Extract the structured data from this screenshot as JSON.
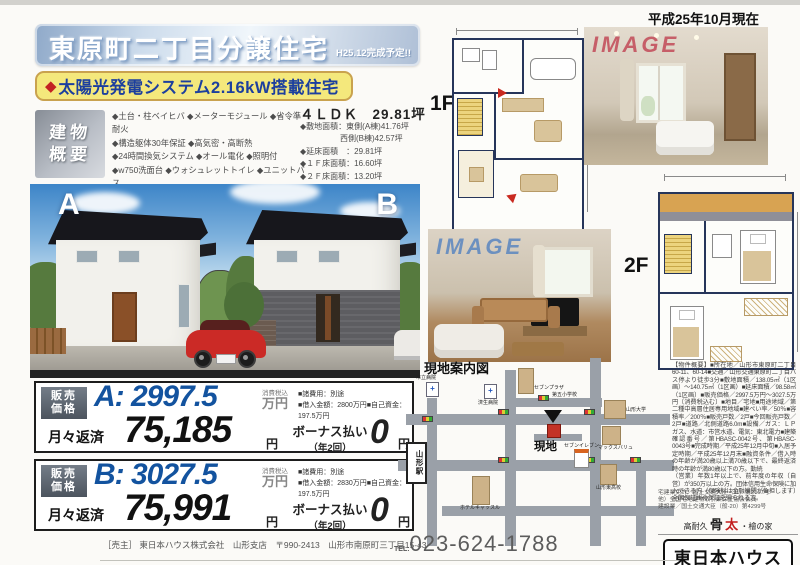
{
  "meta": {
    "date_note": "平成25年10月現在"
  },
  "header": {
    "title": "東原町二丁目分譲住宅",
    "badge": "H25.12完成予定!!",
    "diamond": "◆",
    "highlight": "太陽光発電システム2.16kW搭載住宅"
  },
  "overview": {
    "label1": "建物",
    "label2": "概要",
    "features": [
      "◆土台・柱ベイヒバ ◆メーターモジュール ◆省令準耐火",
      "◆構造躯体30年保証 ◆高気密・高断熱",
      "◆24時間換気システム ◆オール電化 ◆照明付",
      "◆w750洗面台 ◆ウォシュレットトイレ ◆ユニットバス",
      "◆リビングエアコン ◆ＴＶインターホン ◆エコキュート"
    ],
    "plan_type": "４ＬＤＫ　29.81坪",
    "spec1": "◆敷地面積：東側(A棟)41.76坪",
    "spec2": "西側(B棟)42.57坪",
    "spec3": "◆延床面積　：29.81坪",
    "spec4": "◆１Ｆ床面積：16.60坪",
    "spec5": "◆２Ｆ床面積：13.20坪"
  },
  "rendering": {
    "label_a": "A",
    "label_b": "B"
  },
  "price_a": {
    "label1": "販売",
    "label2": "価格",
    "price": "A: 2997.5",
    "tax": "消費税込",
    "unit": "万円",
    "note1": "■諸費用：別途",
    "note2": "■借入金額：2800万円■自己資金：197.5万円",
    "monthly_label": "月々返済",
    "monthly": "75,185",
    "yen1": "円",
    "bonus_label": "ボーナス払い",
    "bonus_term": "（年2回）",
    "bonus": "0",
    "yen2": "円"
  },
  "price_b": {
    "label1": "販売",
    "label2": "価格",
    "price": "B: 3027.5",
    "tax": "消費税込",
    "unit": "万円",
    "note1": "■諸費用：別途",
    "note2": "■借入金額：2830万円■自己資金：197.5万円",
    "monthly_label": "月々返済",
    "monthly": "75,991",
    "yen1": "円",
    "bonus_label": "ボーナス払い",
    "bonus_term": "（年2回）",
    "bonus": "0",
    "yen2": "円"
  },
  "plans": {
    "f1": "1F",
    "f2": "2F"
  },
  "photos": {
    "watermark": "IMAGE"
  },
  "map": {
    "title": "現地案内図",
    "site": "現地",
    "station": "山形駅",
    "l_sevenplaza": "セブンプラザ",
    "l_school": "第五小学校",
    "l_univ": "山形大学",
    "l_seveneleven": "セブンイレブン",
    "l_maxvalu": "マックスバリュ",
    "l_hotel": "ホテルキャッスル",
    "l_hosp1": "市立病院",
    "l_hosp2": "済生病院",
    "l_se_bldg": "山形東高校"
  },
  "legal": {
    "p1": "【物件概要】■所在地／山形市東原町二丁目60-11、60-14■交通／山形交通東原町二丁目バス停より徒歩3分■敷地面積／138.05㎡（1区画）〜140.75㎡（1区画）■延床面積／98.58㎡（1区画）■販売価格／2997.5万円〜3027.5万円〔消費税込む〕■地目／宅地■用途地域／第二種中高層住居専用地域■建ぺい率／50％■容積率／200％■販売戸数／2戸■今回販売戸数／2戸■道路／北側道路6.0m■設備／ガス：ＬＰガス、水道：市営水道、電気：東北電力■建築確認番号／第HBASC-0042号、第HBASC-0043号■完成時期／平成25年12月中旬■入居予定時期／平成25年12月末■融資条件／借入時の年齢が満20歳以上満70歳以下で、最終返済時の年齢が満80歳以下の方。勤続",
    "p2": "（営業）年数1年以上で、前年度の年収（自営）が350万以上の方。団体信用生命保険に加入できる方（保険料は金融機関が負担します）全国保証㈱の保証を得られる方。"
  },
  "footer": {
    "seller": "［売主］ 東日本ハウス株式会社　山形支店　〒990-2413　山形市南原町三丁目15-43",
    "tel_label": "TEL:",
    "tel": "023-624-1788"
  },
  "brand": {
    "license1": "宅建業免許／国土交通大臣（11）第2167号",
    "license2": "他）全国宅地建物取引業保証協会会員",
    "license3": "建設業／国土交通大臣（般-20）第4299号",
    "tag1": "高耐久",
    "tag2": "骨",
    "tag3": "太",
    "tag4": "・檜の家",
    "logo": "東日本ハウス"
  }
}
